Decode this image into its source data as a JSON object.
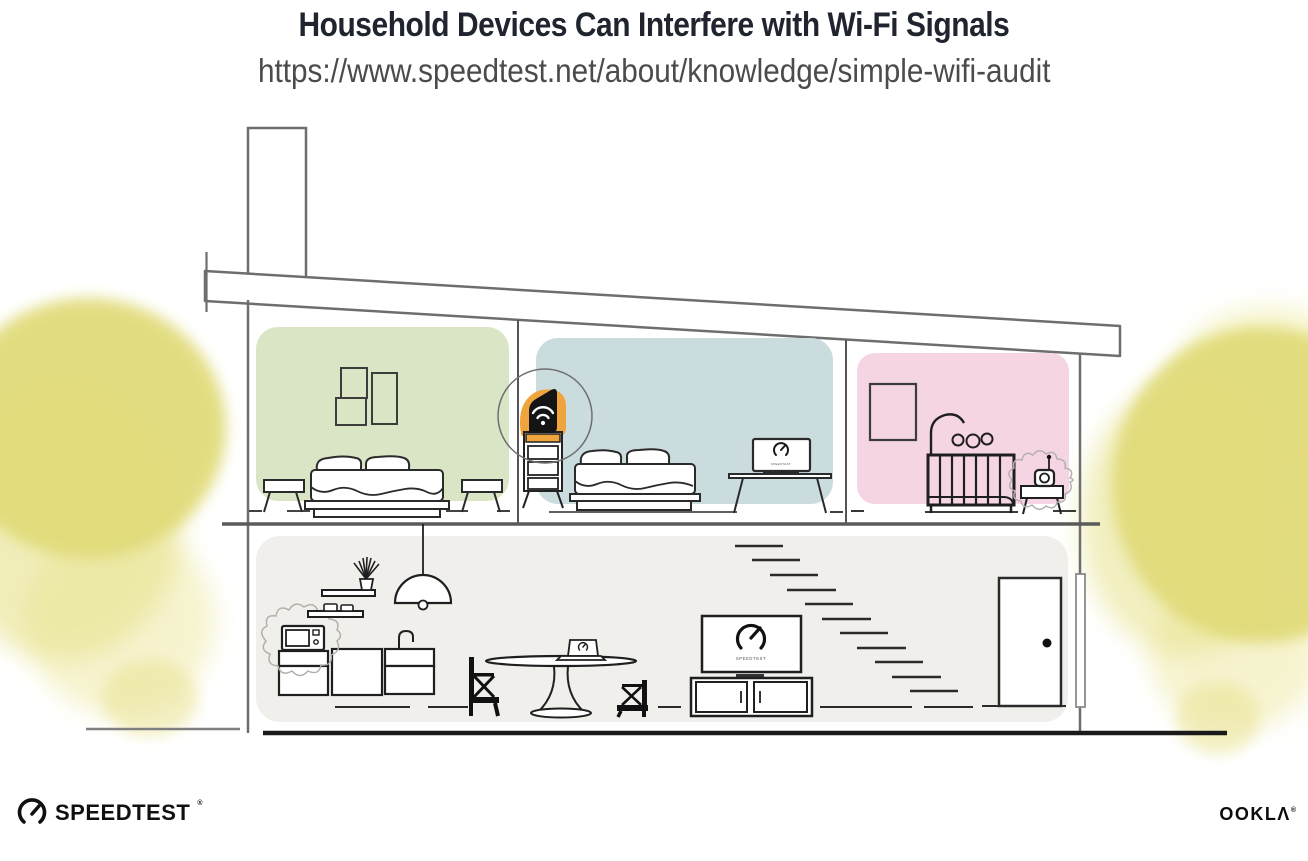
{
  "header": {
    "title": "Household Devices Can Interfere with Wi-Fi Signals",
    "url": "https://www.speedtest.net/about/knowledge/simple-wifi-audit"
  },
  "illustration": {
    "scene": "two-story house cross-section showing a wi-fi router and interfering household devices",
    "router": {
      "icon": "wifi-icon",
      "highlight_color": "#f0a43e"
    },
    "screens": {
      "tv_label": "SPEEDTEST",
      "desk_laptop_label": "SPEEDTEST"
    },
    "rooms": [
      {
        "name": "bedroom-left",
        "color": "#d9e5c5"
      },
      {
        "name": "bedroom-middle",
        "color": "#cbdcdf"
      },
      {
        "name": "nursery",
        "color": "#f5d4e4"
      },
      {
        "name": "downstairs-living-area",
        "color": "#f1efec"
      }
    ],
    "interference_devices": [
      "microwave",
      "baby-monitor"
    ],
    "foliage_color": "#e0da77",
    "line_color_structure": "#6e6e6e",
    "line_color_furniture": "#1f1f1f"
  },
  "footer": {
    "speedtest": {
      "label": "SPEEDTEST",
      "reg_mark": "®",
      "icon": "speedtest-gauge-icon"
    },
    "ookla": {
      "label": "OOKLΛ",
      "reg_mark": "®"
    }
  }
}
